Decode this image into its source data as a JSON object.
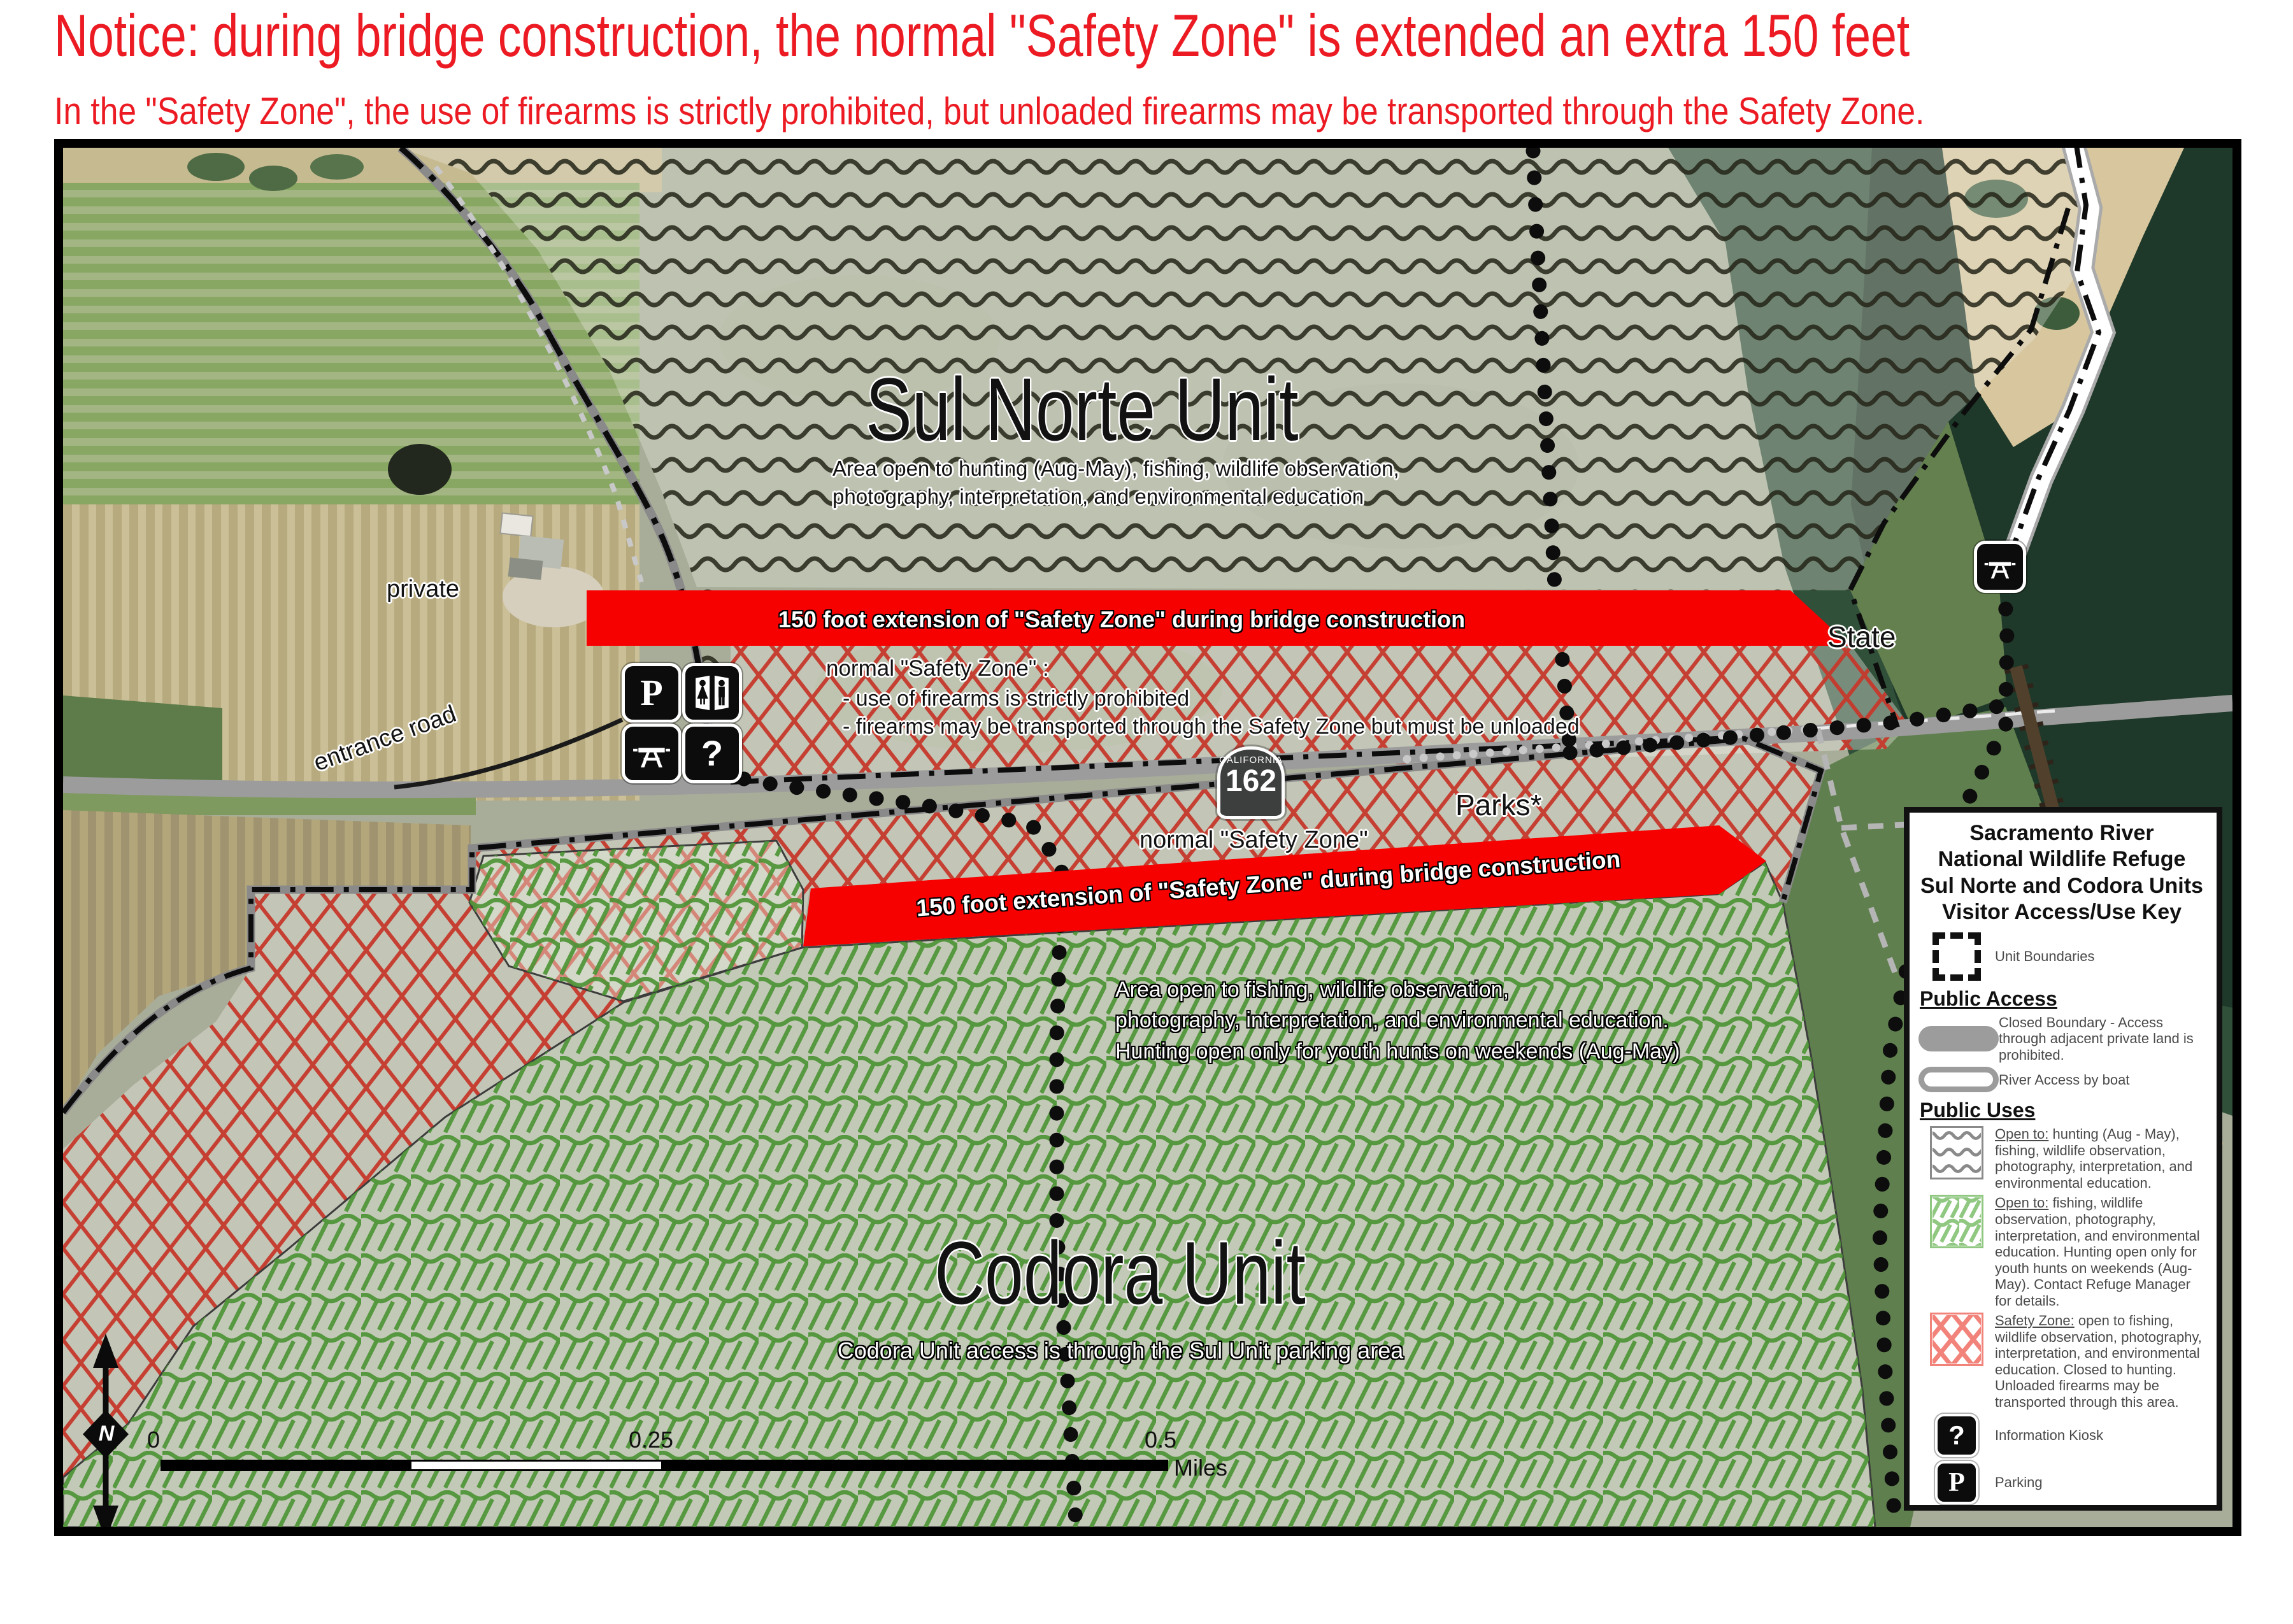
{
  "notice": {
    "title": "Notice: during bridge construction, the normal \"Safety Zone\" is extended an extra 150 feet",
    "subtitle": "In the \"Safety Zone\", the use of firearms is strictly prohibited, but unloaded firearms may be transported through the Safety Zone."
  },
  "map": {
    "labels": {
      "sul_norte_title": "Sul Norte Unit",
      "sul_norte_desc1": "Area open to hunting (Aug-May), fishing, wildlife observation,",
      "sul_norte_desc2": "photography, interpretation, and environmental education",
      "banner_top": "150 foot extension of \"Safety Zone\" during bridge construction",
      "banner_bottom": "150 foot extension of \"Safety Zone\" during bridge construction",
      "nsz_heading": "normal \"Safety Zone\" :",
      "nsz_line1": "- use of firearms is strictly prohibited",
      "nsz_line2": "- firearms may be transported through the Safety Zone but must be unloaded",
      "nsz_label2": "normal \"Safety Zone\"",
      "codora_desc1": "Area open to fishing, wildlife observation,",
      "codora_desc2": "photography, interpretation, and environmental education.",
      "codora_desc3": "Hunting open only for youth hunts on weekends (Aug-May)",
      "codora_title": "Codora Unit",
      "codora_access": "Codora Unit access is through the Sul Unit parking area",
      "private_label": "private",
      "entrance_road": "entrance road",
      "state": "State",
      "parks": "Parks*"
    },
    "shield": {
      "state": "CALIFORNIA",
      "number": "162"
    },
    "scale": {
      "zero": "0",
      "quarter": "0.25",
      "half": "0.5",
      "unit": "Miles"
    },
    "north": "N"
  },
  "legend": {
    "title_lines": [
      "Sacramento River",
      "National Wildlife Refuge",
      "Sul Norte and Codora Units",
      "Visitor Access/Use Key"
    ],
    "unit_boundaries": "Unit Boundaries",
    "public_access": "Public Access",
    "closed_boundary": "Closed Boundary - Access through adjacent private land is prohibited.",
    "river_access": "River Access by boat",
    "public_uses": "Public Uses",
    "uses": [
      {
        "prefix": "Open to:",
        "text": " hunting (Aug - May), fishing, wildlife observation, photography, interpretation, and environmental education."
      },
      {
        "prefix": "Open to:",
        "text": " fishing, wildlife observation, photography, interpretation, and environmental education.  Hunting open only for youth hunts on weekends (Aug-May).  Contact Refuge Manager for details."
      },
      {
        "prefix": "Safety Zone:",
        "text": " open to fishing, wildlife observation, photography, interpretation, and environmental education.  Closed to hunting.  Unloaded firearms may be transported through this area."
      }
    ],
    "info_kiosk": "Information Kiosk",
    "parking": "Parking",
    "picnic": "Picnic Area",
    "restroom": "Restroom",
    "trail": "Trail"
  }
}
